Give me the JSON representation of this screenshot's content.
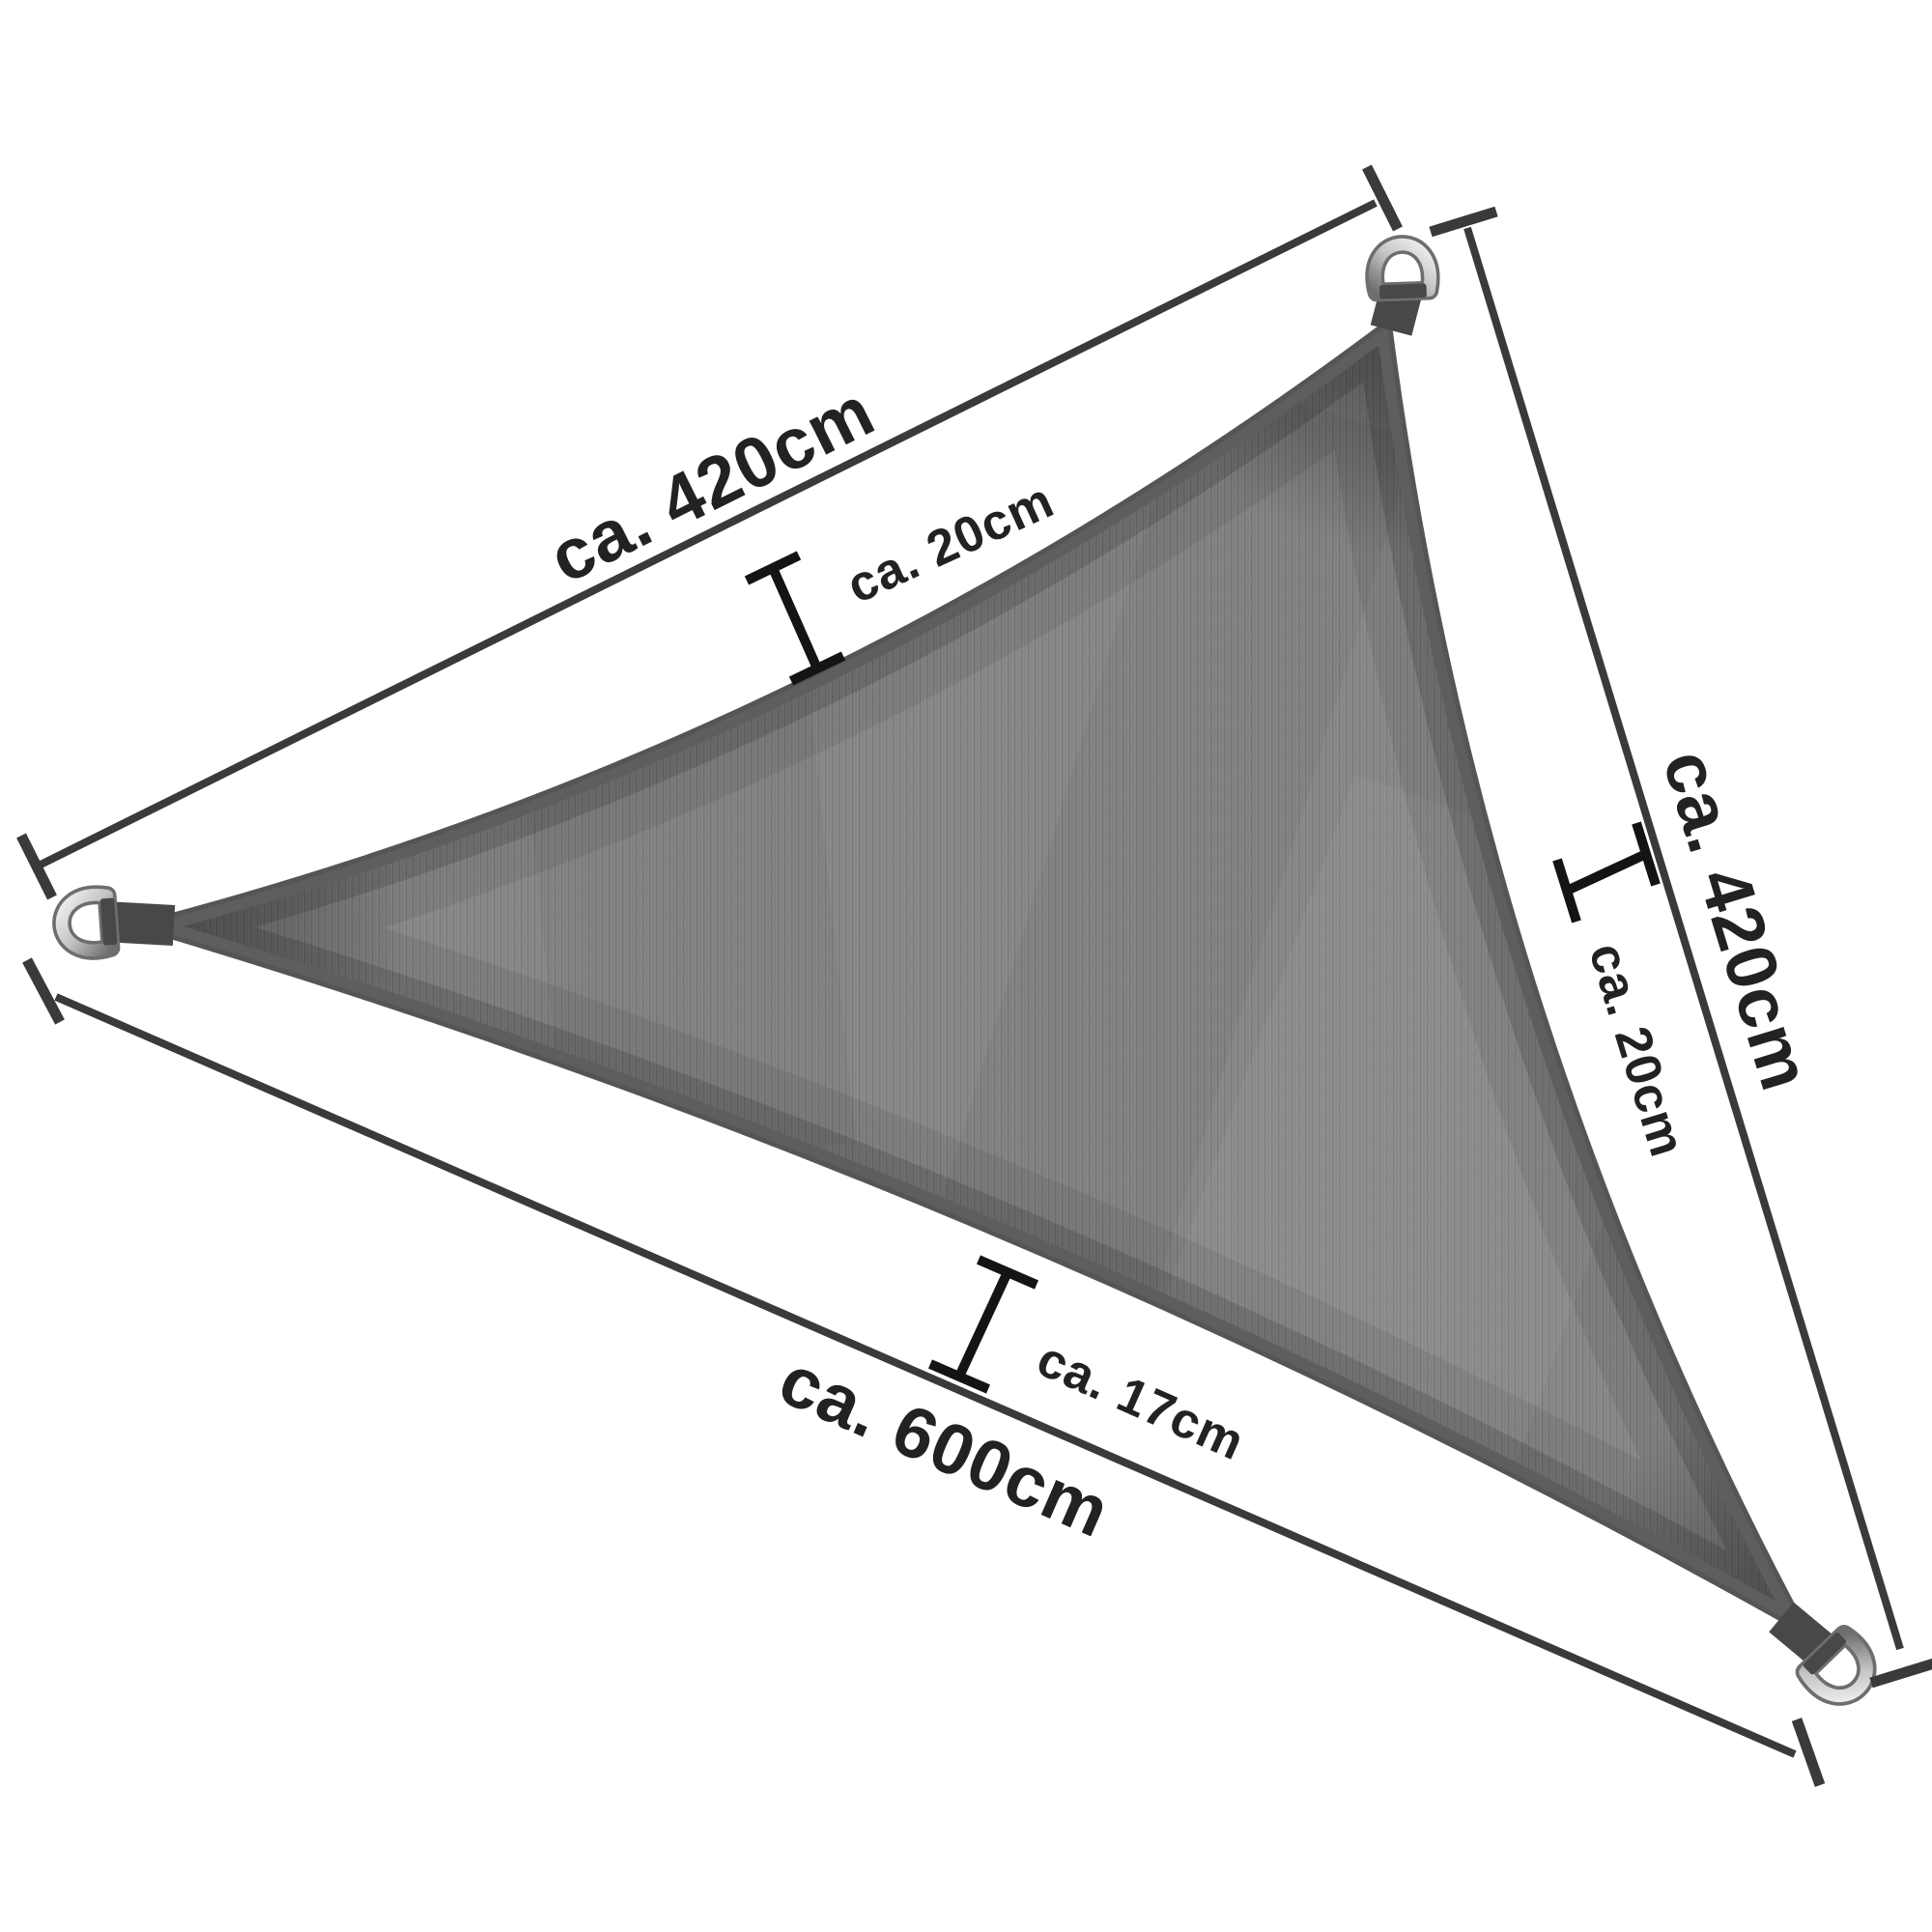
{
  "labels": {
    "side_top_left": "ca. 420cm",
    "side_right": "ca. 420cm",
    "side_bottom": "ca. 600cm",
    "curve_top": "ca. 20cm",
    "curve_right": "ca. 20cm",
    "curve_bottom": "ca. 17cm"
  },
  "hardware": {
    "corner_fitting": "d-ring",
    "count": 3
  },
  "colors": {
    "background": "#ffffff",
    "fabric_base": "#8d8d8d",
    "fabric_rib_dark": "#747474",
    "fabric_rib_mid": "#7f7f7f",
    "fabric_row": "#848484",
    "hem_band": "#5e5e5e",
    "sail_outline": "#555555",
    "strap": "#484848",
    "dimension_line": "#3a3a3a",
    "marker": "#141414",
    "label_text": "#222222",
    "metal_light": "#f4f4f4",
    "metal_mid": "#c3c3c3",
    "metal_dark": "#6e6e6e"
  }
}
